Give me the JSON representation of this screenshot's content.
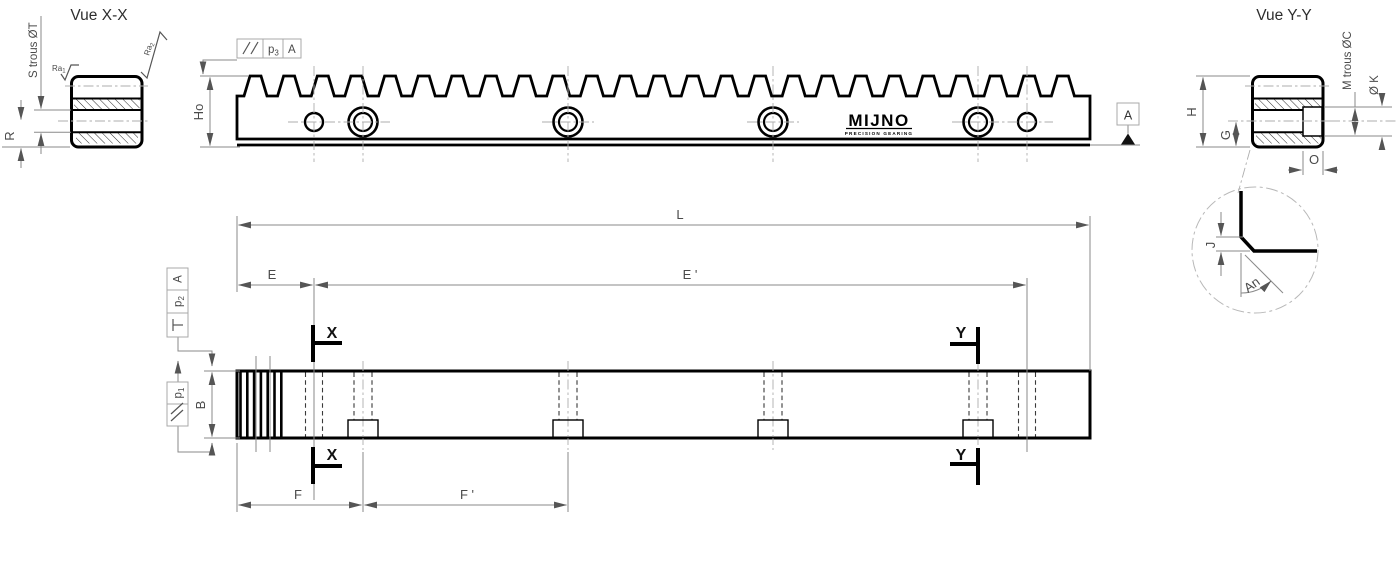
{
  "titles": {
    "xx": "Vue X-X",
    "yy": "Vue Y-Y"
  },
  "logo": {
    "name": "MIJNO",
    "tagline": "PRECISION GEARING"
  },
  "labels": {
    "ho": "Ho",
    "datum": "A",
    "fcf_top": {
      "p": "p",
      "sub": "3",
      "datum": "A"
    },
    "s_trous": "S trous ØT",
    "r": "R",
    "ra": "Ra",
    "ra1_sub": "1",
    "ra2_sub": "2",
    "m_trous": "M trous ØC",
    "ok": "Ø K",
    "h": "H",
    "g": "G",
    "o": "O",
    "j": "J",
    "an": "An",
    "l": "L",
    "e": "E",
    "e2": "E '",
    "f": "F",
    "f2": "F '",
    "b": "B",
    "x": "X",
    "y": "Y",
    "fcf_perp": {
      "p": "p",
      "sub": "2",
      "datum": "A"
    },
    "fcf_par": {
      "p": "p",
      "sub": "1"
    }
  },
  "colors": {
    "outline": "#000000",
    "dimension": "#8a8a8a",
    "text": "#4a4a4a"
  }
}
